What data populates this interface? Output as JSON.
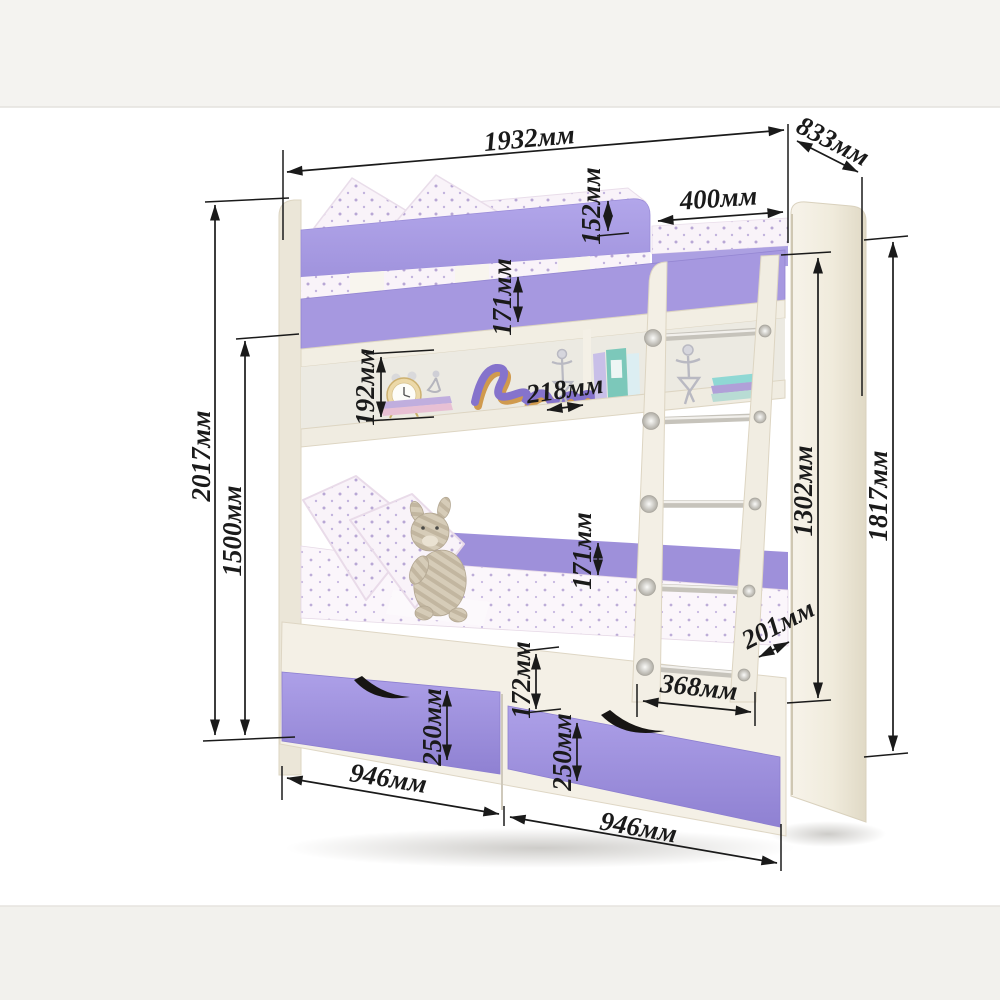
{
  "diagram": {
    "kind": "bunk-bed-dimension-diagram",
    "units": "мм"
  },
  "colors": {
    "accent_purple": "#ab9fe6",
    "rail_purple": "#a698e0",
    "drawer_purple": "#a396e0",
    "furniture_cream": "#f3efe5",
    "dimension_ink": "#1a1a1a",
    "background": "#ffffff"
  },
  "dimensions": {
    "w_top": "1932мм",
    "depth": "833мм",
    "rail_above_mattress": "152мм",
    "top_gap": "400мм",
    "upper_rail_band": "171мм",
    "shelf_opening": "192мм",
    "shelf_depth": "218мм",
    "total_height": "2017мм",
    "upper_bunk_height": "1500мм",
    "inner_column_height": "1302мм",
    "side_panel_height": "1817мм",
    "lower_rail_band": "171мм",
    "ladder_depth": "201мм",
    "base_band": "172мм",
    "ladder_width": "368мм",
    "drawer_left_height": "250мм",
    "drawer_right_height": "250мм",
    "drawer_left_width": "946мм",
    "drawer_right_width": "946мм"
  }
}
